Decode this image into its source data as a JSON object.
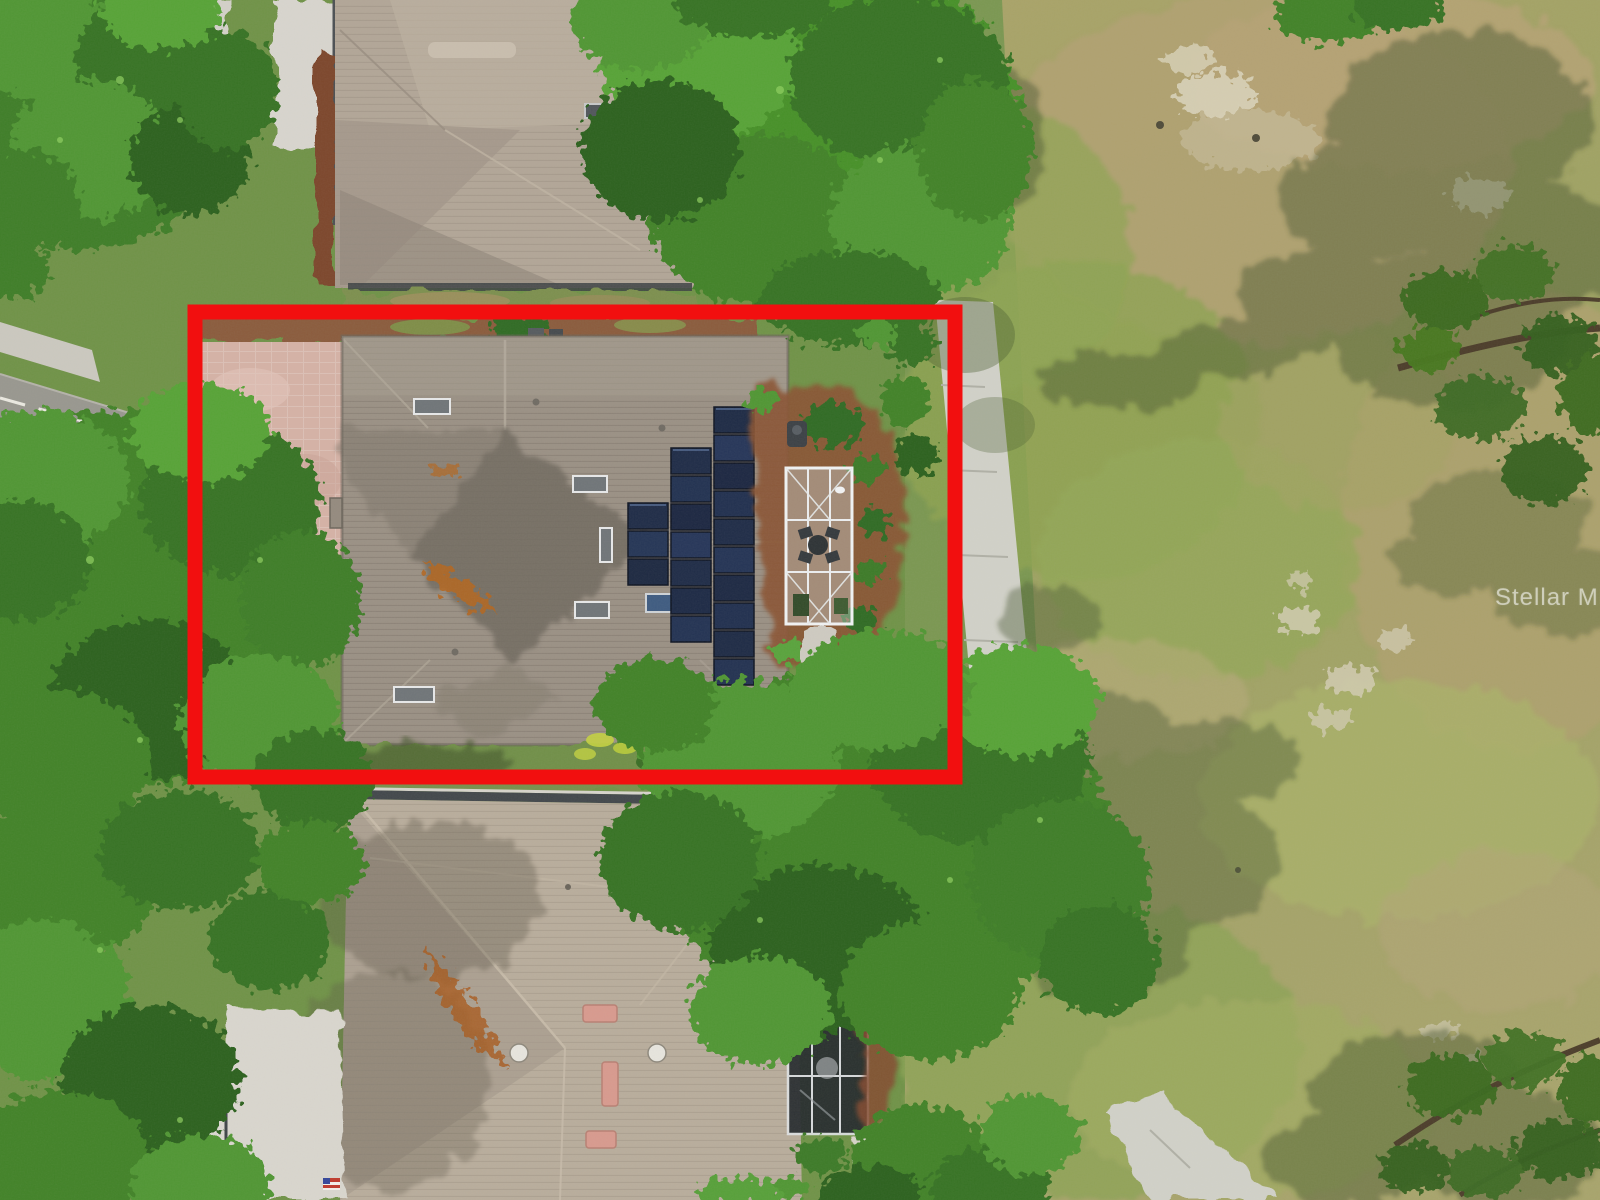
{
  "watermark": {
    "text": "Stellar MLS"
  },
  "highlight_box": {
    "color": "#f20f0f"
  },
  "scene": {
    "solar_array": {
      "panel_color": "#1d2a46",
      "columns_panel_counts": [
        3,
        7,
        10
      ]
    },
    "colors": {
      "highlight_red": "#f20f0f",
      "subject_roof": "#9a9084",
      "subject_roof_shadow": "#6e675d",
      "neighbor_roof_top": "#b2a697",
      "neighbor_roof_bottom": "#b9ad9c",
      "tree_canopy": "#3f8227",
      "fairway_grass": "#a3a066",
      "fairway_dry": "#b4a173",
      "cart_path": "#d2d2c9",
      "paver_driveway": "#d6b2a6",
      "mulch_bed": "#8a5233",
      "screen_enclosure_frame": "#f2f4f5",
      "watermark_text": "#ffffff"
    }
  }
}
